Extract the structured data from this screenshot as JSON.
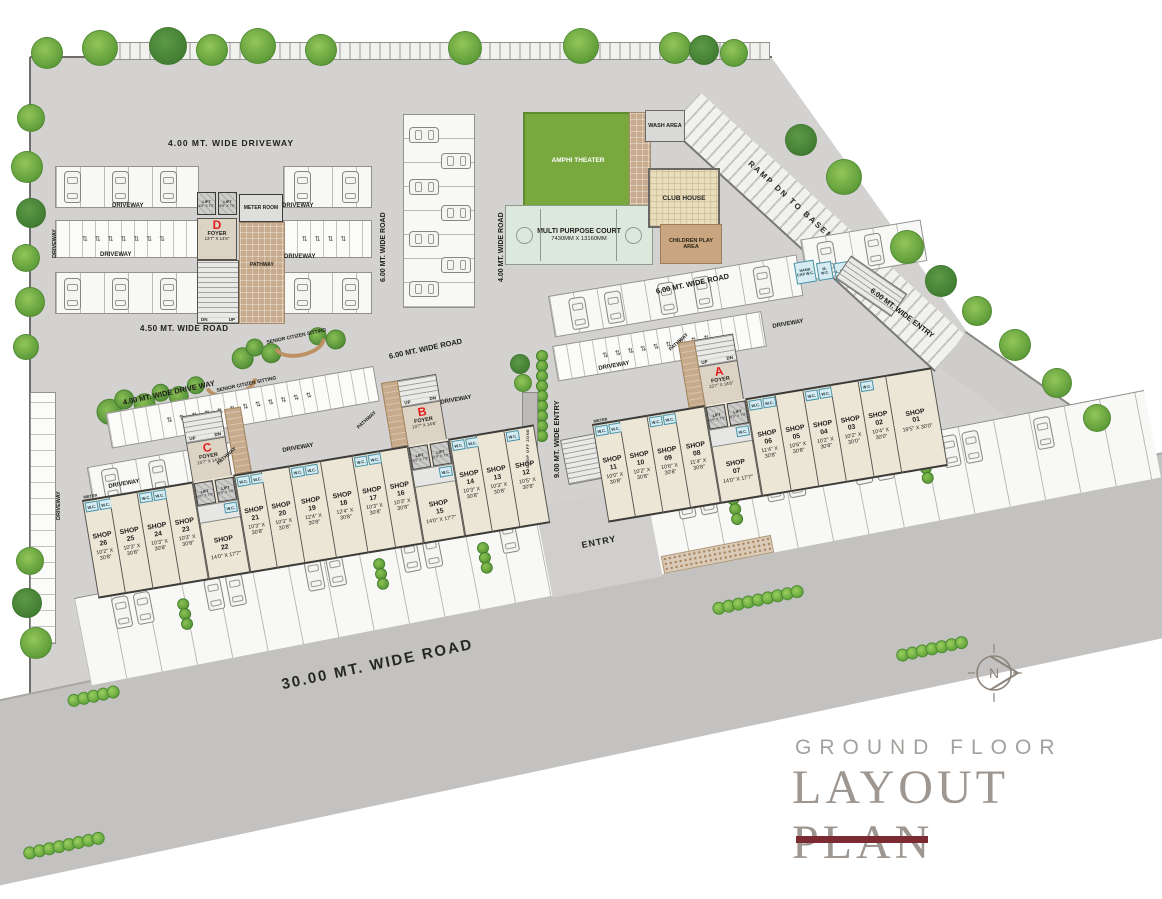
{
  "title": {
    "pre": "GROUND FLOOR",
    "main": "LAYOUT PLAN"
  },
  "compass": {
    "letter": "N"
  },
  "labels": {
    "shop": "SHOP",
    "foyer": "FOYER",
    "foyer_dims": "13'7\" X 14'6\"",
    "lift": "LIFT",
    "lift_dims": "6'5\" X 7'0\"",
    "up": "UP",
    "dn": "DN",
    "wc": "W.C.",
    "meter": "METER",
    "meter_room": "METER ROOM",
    "handicap_wc": "HAND CAP W.C.",
    "m_wc": "M. W.C.",
    "l_wc": "L. W.C.",
    "garbage": "GARBAGE",
    "driveway": "DRIVEWAY",
    "pathway": "PATHWAY",
    "entry": "ENTRY",
    "drop_off": "DROP OFF ZONE"
  },
  "roads": {
    "driveway_400_top": "4.00 MT. WIDE DRIVEWAY",
    "road_450": "4.50 MT. WIDE ROAD",
    "driveway_400_left": "4.00 MT. WIDE DRIVE WAY",
    "road_600_v": "6.00 MT. WIDE ROAD",
    "road_400_v": "4.00 MT. WIDE ROAD",
    "road_600_a": "6.00 MT. WIDE ROAD",
    "road_600_b": "6.00 MT. WIDE ROAD",
    "entry_900": "9.00 MT. WIDE ENTRY",
    "entry_600": "6.00 MT. WIDE ENTRY",
    "ramp": "RAMP DN TO BASEMENT",
    "road_3000": "30.00 MT. WIDE ROAD"
  },
  "amenities": {
    "amphi": "AMPHI THEATER",
    "court": "MULTI PURPOSE COURT",
    "court_dims": "7430MM X 13160MM",
    "club": "CLUB HOUSE",
    "wash": "WASH AREA",
    "children": "CHILDREN PLAY AREA",
    "senior": "SENIOR CITIZEN SITTING"
  },
  "foyers": {
    "a": "A",
    "b": "B",
    "c": "C",
    "d": "D"
  },
  "shops": [
    {
      "num": "01",
      "dims": "19'5\" X 30'0\""
    },
    {
      "num": "02",
      "dims": "10'4\" X 30'0\""
    },
    {
      "num": "03",
      "dims": "10'2\" X 30'0\""
    },
    {
      "num": "04",
      "dims": "10'2\" X 30'8\""
    },
    {
      "num": "05",
      "dims": "10'6\" X 30'8\""
    },
    {
      "num": "06",
      "dims": "11'4\" X 30'8\""
    },
    {
      "num": "07",
      "dims": "14'0\" X 17'7\""
    },
    {
      "num": "08",
      "dims": "11'4\" X 30'8\""
    },
    {
      "num": "09",
      "dims": "10'6\" X 30'8\""
    },
    {
      "num": "10",
      "dims": "10'2\" X 30'8\""
    },
    {
      "num": "11",
      "dims": "10'0\" X 30'8\""
    },
    {
      "num": "12",
      "dims": "10'5\" X 30'8\""
    },
    {
      "num": "13",
      "dims": "10'3\" X 30'8\""
    },
    {
      "num": "14",
      "dims": "10'3\" X 30'8\""
    },
    {
      "num": "15",
      "dims": "14'0\" X 17'7\""
    },
    {
      "num": "16",
      "dims": "10'3\" X 30'8\""
    },
    {
      "num": "17",
      "dims": "10'3\" X 30'8\""
    },
    {
      "num": "18",
      "dims": "12'4\" X 30'8\""
    },
    {
      "num": "19",
      "dims": "12'4\" X 30'8\""
    },
    {
      "num": "20",
      "dims": "10'3\" X 30'8\""
    },
    {
      "num": "21",
      "dims": "10'3\" X 30'8\""
    },
    {
      "num": "22",
      "dims": "14'0\" X 17'7\""
    },
    {
      "num": "23",
      "dims": "10'3\" X 30'8\""
    },
    {
      "num": "24",
      "dims": "10'3\" X 30'8\""
    },
    {
      "num": "25",
      "dims": "10'3\" X 30'8\""
    },
    {
      "num": "26",
      "dims": "10'2\" X 30'8\""
    }
  ]
}
